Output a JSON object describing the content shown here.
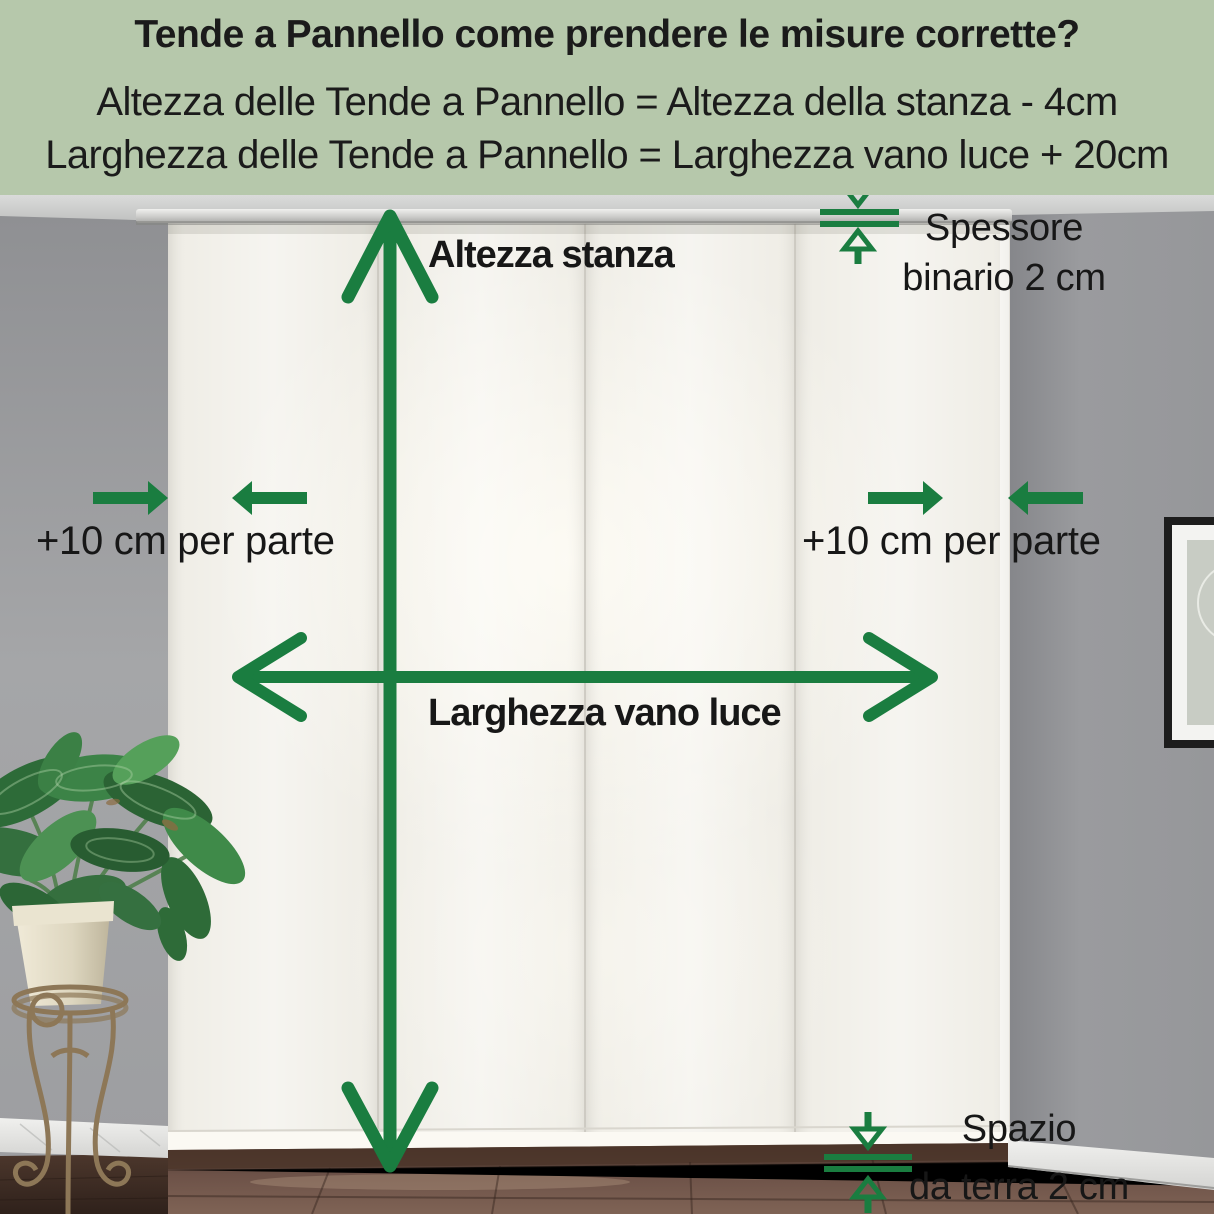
{
  "colors": {
    "header_bg": "#b6c8ab",
    "arrow_green": "#1a7d40",
    "text_dark": "#1b1b1b"
  },
  "header": {
    "title": "Tende a Pannello come prendere le misure corrette?",
    "formula_height": "Altezza delle Tende a Pannello = Altezza della stanza - 4cm",
    "formula_width": "Larghezza delle Tende a Pannello = Larghezza vano luce + 20cm"
  },
  "annotations": {
    "room_height": "Altezza stanza",
    "window_width": "Larghezza vano luce",
    "side_margin_left": "+10 cm per parte",
    "side_margin_right": "+10 cm per parte",
    "track_thickness": {
      "line1": "Spessore",
      "line2": "binario 2 cm"
    },
    "floor_gap": {
      "line1": "Spazio",
      "line2": "da terra 2 cm"
    }
  }
}
